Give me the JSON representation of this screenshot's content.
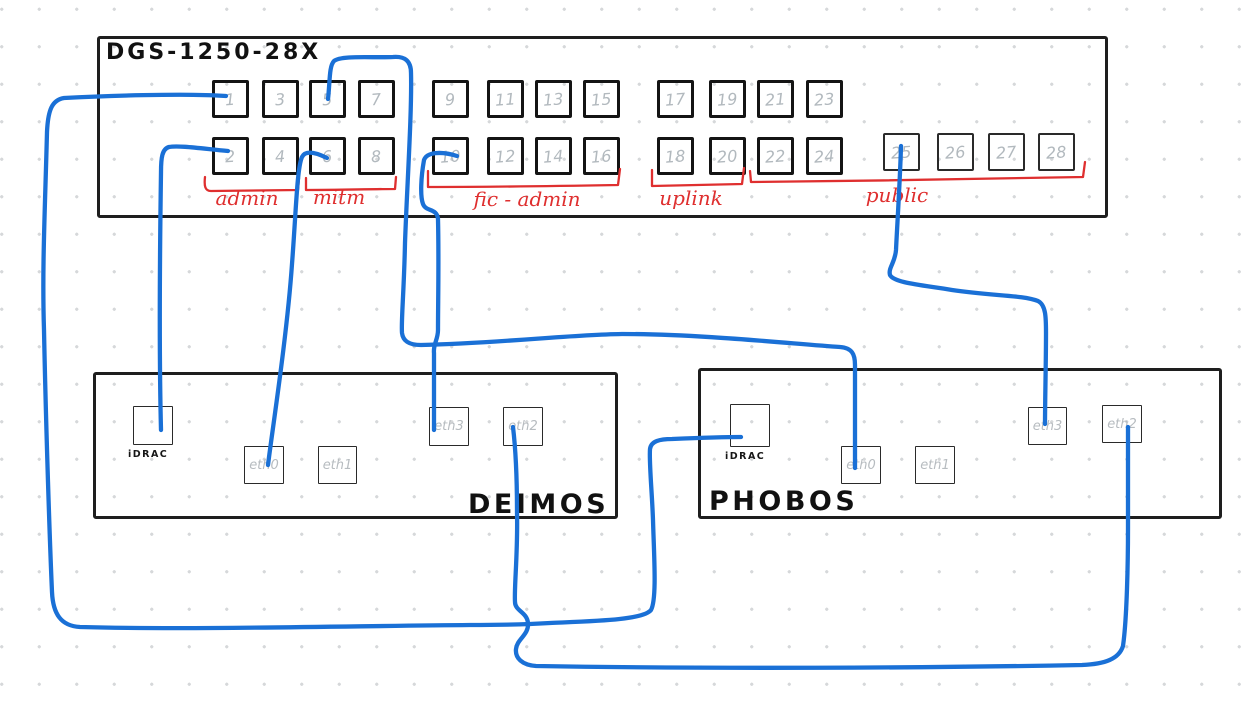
{
  "colors": {
    "cable": "#1a70d6",
    "group": "#df2f2f",
    "stroke": "#1e1e1e",
    "port_number": "#b2b9be",
    "port_label": "#b7bcc0"
  },
  "switch": {
    "title": "DGS-1250-28X",
    "ports": [
      "1",
      "2",
      "3",
      "4",
      "5",
      "6",
      "7",
      "8",
      "9",
      "10",
      "11",
      "12",
      "13",
      "14",
      "15",
      "16",
      "17",
      "18",
      "19",
      "20",
      "21",
      "22",
      "23",
      "24",
      "25",
      "26",
      "27",
      "28"
    ],
    "groups": [
      {
        "label": "admin",
        "ports": "1-4"
      },
      {
        "label": "mitm",
        "ports": "5-8"
      },
      {
        "label": "fic - admin",
        "ports": "9-16"
      },
      {
        "label": "uplink",
        "ports": "17-20"
      },
      {
        "label": "public",
        "ports": "21-28"
      }
    ]
  },
  "servers": [
    {
      "name": "DEIMOS",
      "ports": [
        "iDRAC",
        "eth0",
        "eth1",
        "eth3",
        "eth2"
      ]
    },
    {
      "name": "PHOBOS",
      "ports": [
        "iDRAC",
        "eth0",
        "eth1",
        "eth3",
        "eth2"
      ]
    }
  ],
  "connections": [
    {
      "from": "switch:1",
      "to": "PHOBOS:iDRAC"
    },
    {
      "from": "switch:2",
      "to": "DEIMOS:iDRAC"
    },
    {
      "from": "switch:5",
      "to": "PHOBOS:eth0"
    },
    {
      "from": "switch:6",
      "to": "DEIMOS:eth0"
    },
    {
      "from": "switch:10",
      "to": "DEIMOS:eth3"
    },
    {
      "from": "switch:25",
      "to": "PHOBOS:eth3"
    },
    {
      "from": "DEIMOS:eth2",
      "to": "PHOBOS:eth2"
    }
  ]
}
